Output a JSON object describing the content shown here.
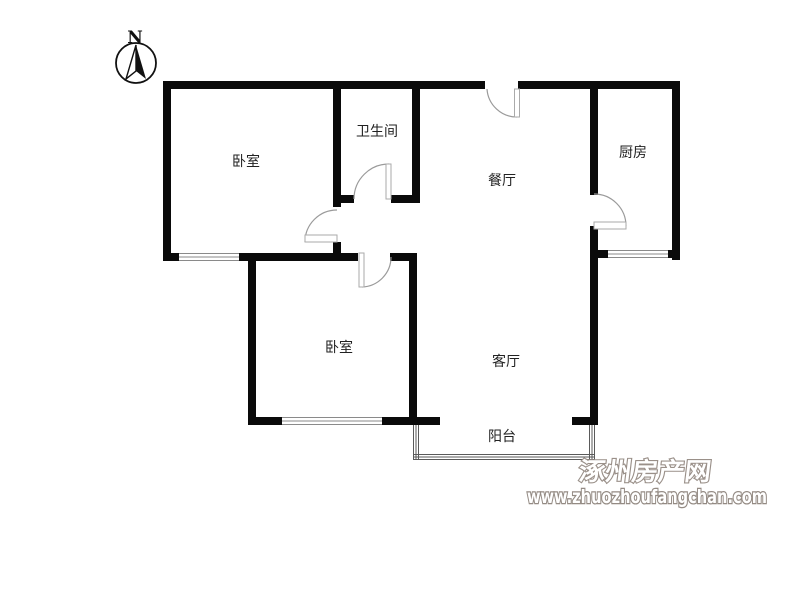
{
  "compass": {
    "label": "N"
  },
  "rooms": [
    {
      "id": "bedroom-top",
      "label": "卧室"
    },
    {
      "id": "bathroom",
      "label": "卫生间"
    },
    {
      "id": "dining-room",
      "label": "餐厅"
    },
    {
      "id": "kitchen",
      "label": "厨房"
    },
    {
      "id": "bedroom-bottom",
      "label": "卧室"
    },
    {
      "id": "living-room",
      "label": "客厅"
    },
    {
      "id": "balcony",
      "label": "阳台"
    }
  ],
  "watermark": {
    "site_name": "涿州房产网",
    "site_url": "www.zhuozhoufangchan.com"
  },
  "colors": {
    "wall": "#0a0a0a",
    "door_arc": "#9a9a9a",
    "window_line": "#8a8a8a",
    "watermark_gray": "#9a9089"
  }
}
